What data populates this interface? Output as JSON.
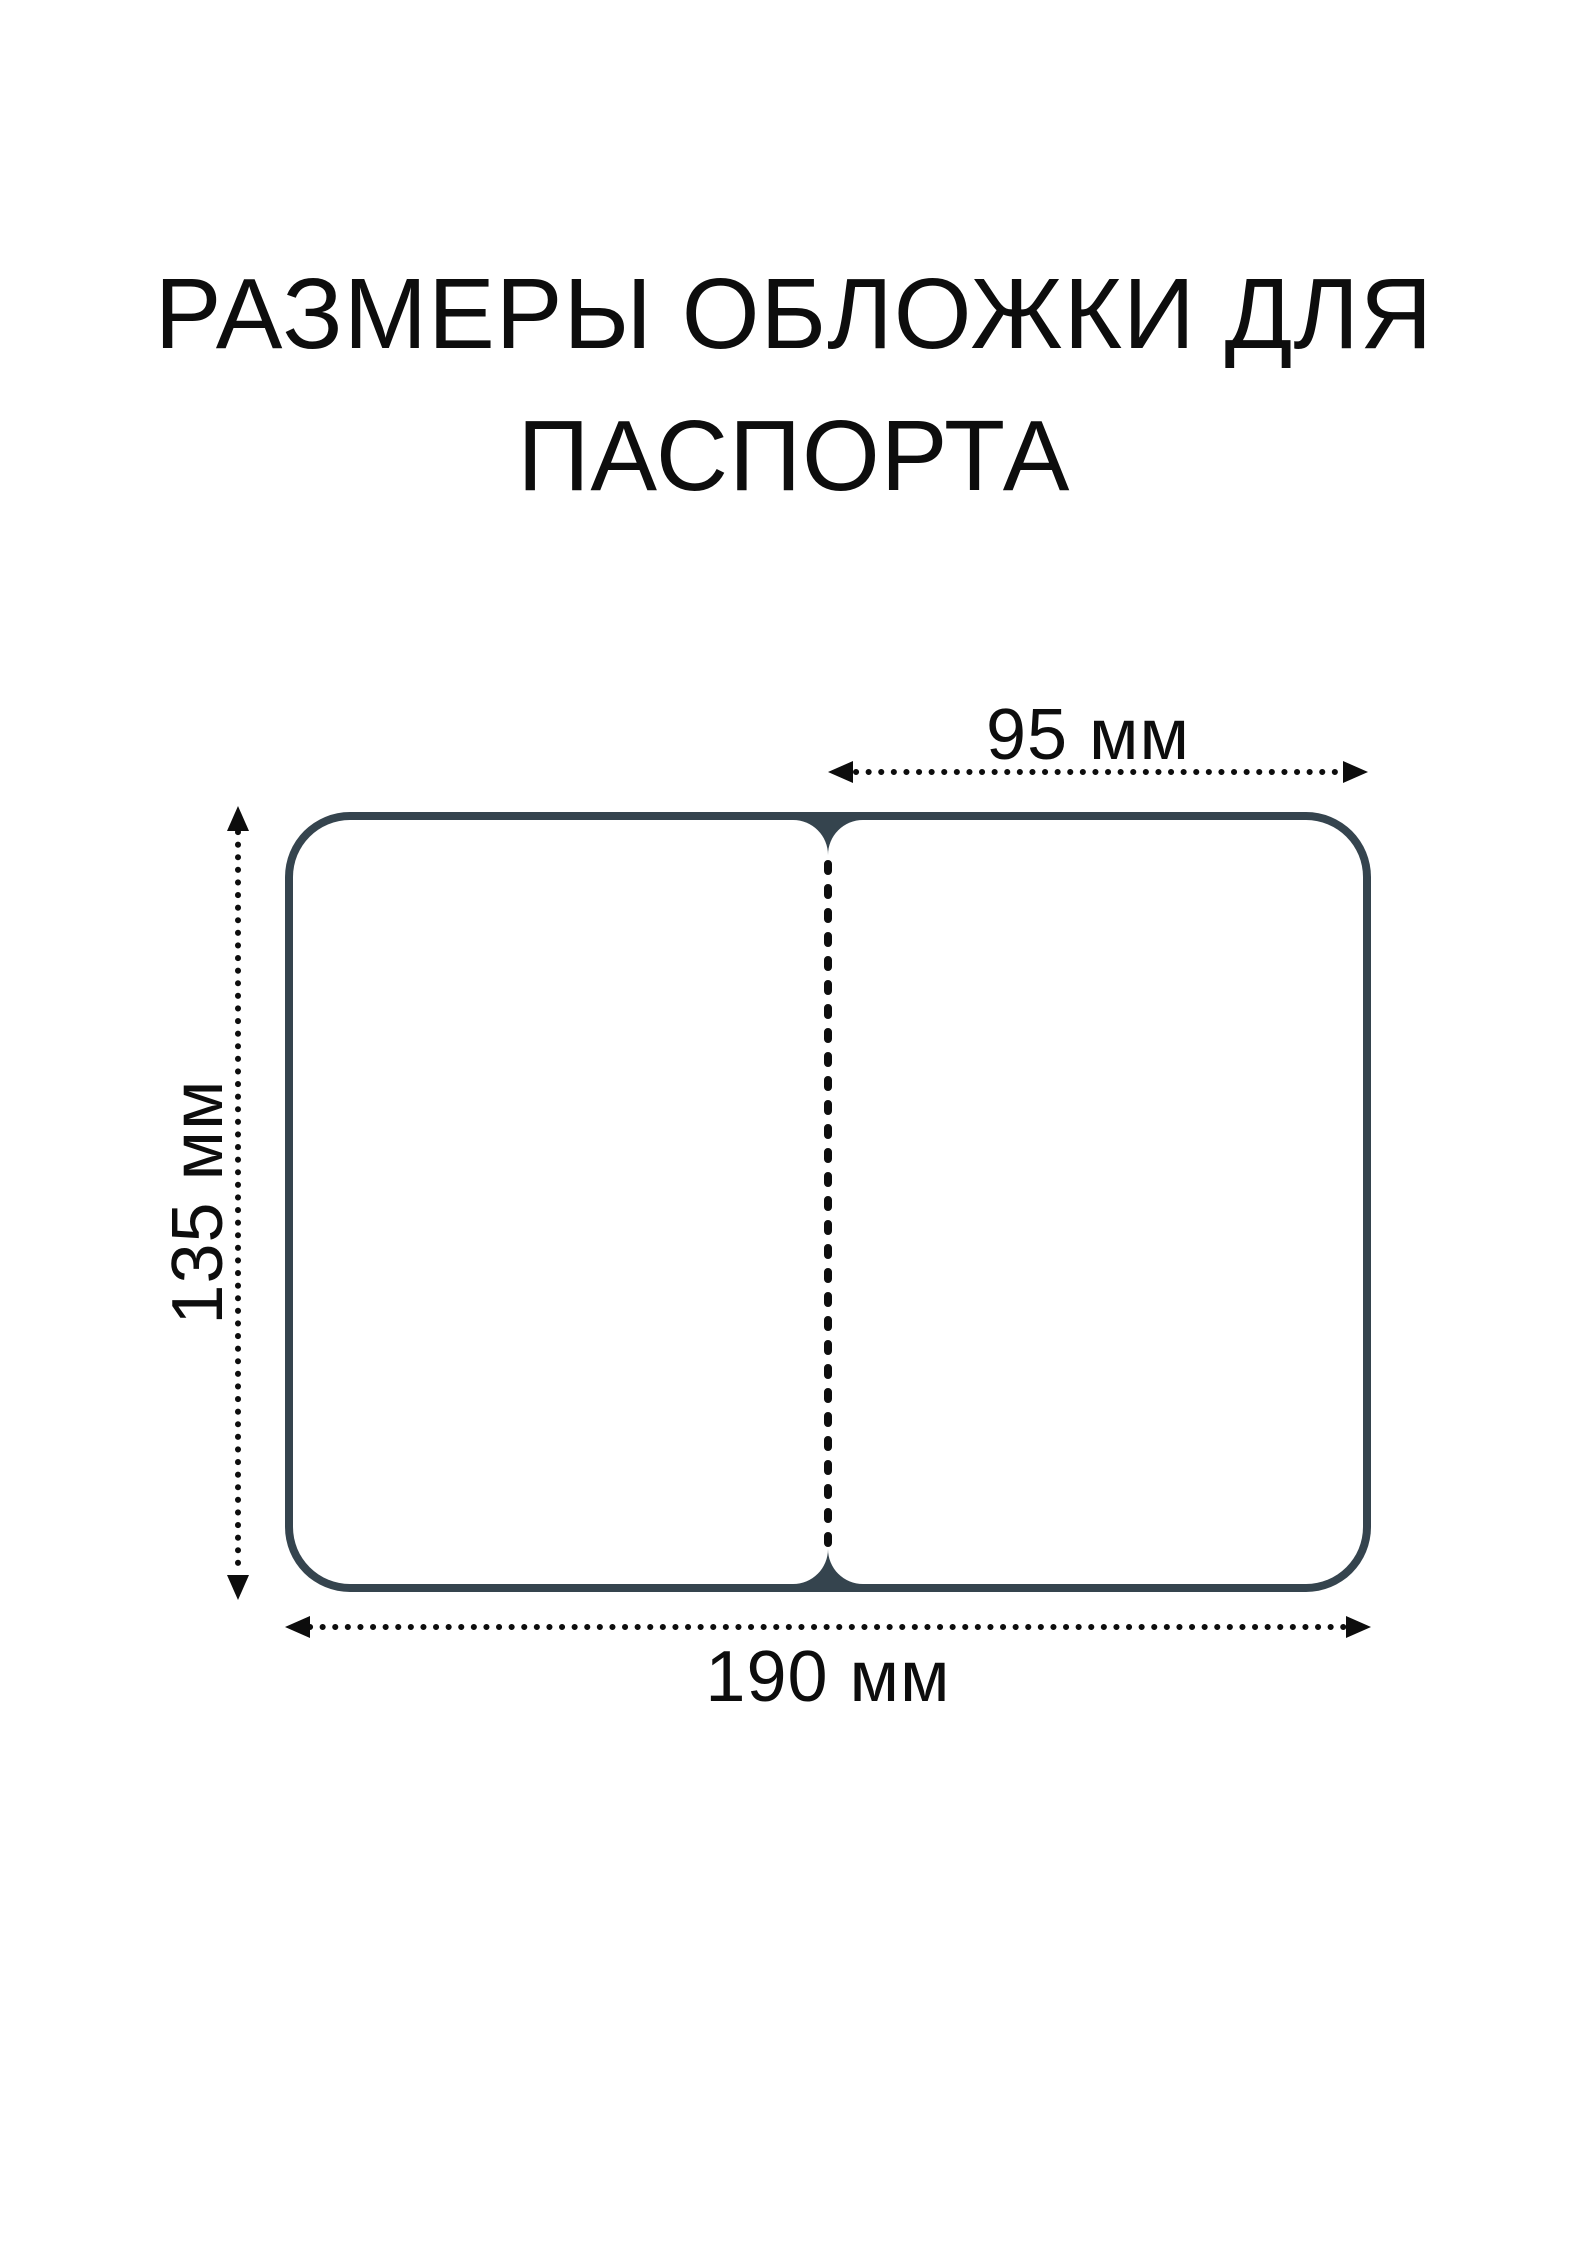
{
  "title": "РАЗМЕРЫ ОБЛОЖКИ ДЛЯ ПАСПОРТА",
  "dimensions": {
    "half_width_top": "95 мм",
    "height_left": "135 мм",
    "full_width_bottom": "190 мм"
  },
  "colors": {
    "cover_outline": "#35444e",
    "ink": "#0d0d0d",
    "background": "#ffffff"
  },
  "icons": {
    "top_arrow": "double-headed-dotted-arrow-horizontal",
    "left_arrow": "double-headed-dotted-arrow-vertical",
    "bottom_arrow": "double-headed-dotted-arrow-horizontal",
    "fold_line": "vertical-dashed-fold-line"
  }
}
